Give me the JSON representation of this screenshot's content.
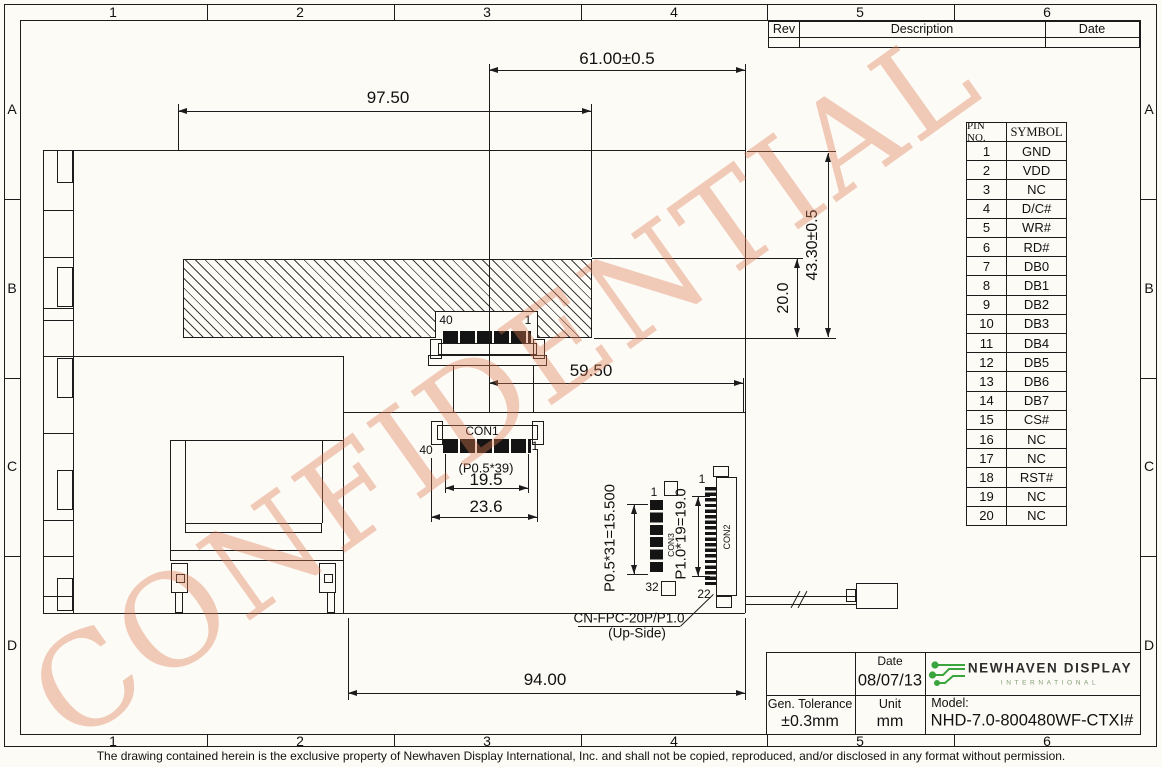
{
  "sheet": {
    "watermark": "CONFIDENTIAL",
    "disclaimer": "The drawing contained herein is the exclusive property of Newhaven Display International, Inc. and shall not be copied, reproduced, and/or disclosed in any format without permission.",
    "border": {
      "columns": [
        "1",
        "2",
        "3",
        "4",
        "5",
        "6"
      ],
      "rows": [
        "A",
        "B",
        "C",
        "D"
      ]
    }
  },
  "rev_table": {
    "rev": "Rev",
    "description": "Description",
    "date": "Date"
  },
  "pin_table": {
    "pin_no_header": "PIN NO.",
    "symbol_header": "SYMBOL",
    "rows": [
      [
        "1",
        "GND"
      ],
      [
        "2",
        "VDD"
      ],
      [
        "3",
        "NC"
      ],
      [
        "4",
        "D/C#"
      ],
      [
        "5",
        "WR#"
      ],
      [
        "6",
        "RD#"
      ],
      [
        "7",
        "DB0"
      ],
      [
        "8",
        "DB1"
      ],
      [
        "9",
        "DB2"
      ],
      [
        "10",
        "DB3"
      ],
      [
        "11",
        "DB4"
      ],
      [
        "12",
        "DB5"
      ],
      [
        "13",
        "DB6"
      ],
      [
        "14",
        "DB7"
      ],
      [
        "15",
        "CS#"
      ],
      [
        "16",
        "NC"
      ],
      [
        "17",
        "NC"
      ],
      [
        "18",
        "RST#"
      ],
      [
        "19",
        "NC"
      ],
      [
        "20",
        "NC"
      ]
    ]
  },
  "title_block": {
    "date_label": "Date",
    "date_value": "08/07/13",
    "tolerance_label": "Gen. Tolerance",
    "tolerance_value": "±0.3mm",
    "unit_label": "Unit",
    "unit_value": "mm",
    "model_label": "Model:",
    "model_value": "NHD-7.0-800480WF-CTXI#",
    "logo_title": "NEWHAVEN DISPLAY",
    "logo_subtitle": "INTERNATIONAL",
    "logo_green": "#3aa53c"
  },
  "drawing": {
    "dims": {
      "top_offset_width": "61.00±0.5",
      "upper_width": "97.50",
      "module_height": "43.30±0.5",
      "backlight_height": "20.0",
      "connector_offset": "59.50",
      "con1_pitch_note": "(P0.5*39)",
      "con1_contact_width": "19.5",
      "con1_body_width": "23.6",
      "pcb_width": "94.00",
      "con3_pitch_note": "P0.5*31=15.500",
      "con2_pitch_note": "P1.0*19=19.0"
    },
    "labels": {
      "con1": "CON1",
      "con2": "CON2",
      "con3": "CON3",
      "pin40": "40",
      "pin1": "1",
      "pin32": "32",
      "pin22": "22",
      "fpc_connector": "CN-FPC-20P/P1.0",
      "fpc_orientation": "(Up-Side)"
    }
  }
}
